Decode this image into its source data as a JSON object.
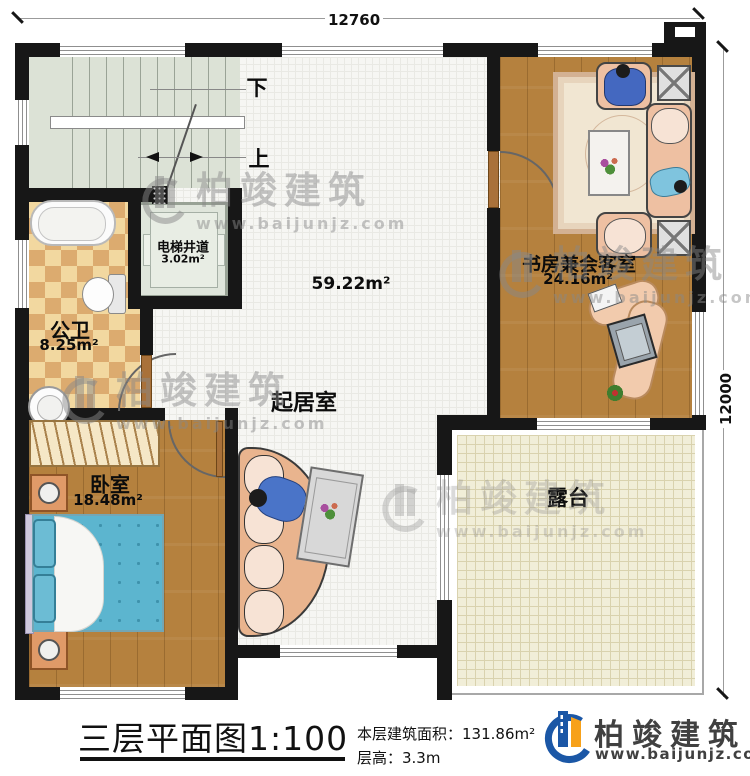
{
  "dimensions": {
    "top": "12760",
    "right": "12000"
  },
  "stairs": {
    "down": "下",
    "up": "上"
  },
  "rooms": {
    "elevator": {
      "name": "电梯井道",
      "area": "3.02m²"
    },
    "bathroom": {
      "name": "公卫",
      "area": "8.25m²"
    },
    "living": {
      "name": "起居室",
      "area": "59.22m²"
    },
    "study": {
      "name": "书房兼会客室",
      "area": "24.16m²"
    },
    "bedroom": {
      "name": "卧室",
      "area": "18.48m²"
    },
    "terrace": {
      "name": "露台"
    }
  },
  "title_block": {
    "title": "三层平面图1:100",
    "building_area": "本层建筑面积：131.86m²",
    "floor_height": "层高：3.3m",
    "brand": "柏竣建筑",
    "website": "www.baijunjz.com"
  },
  "watermark": {
    "brand": "柏竣建筑",
    "website": "www.baijunjz.com"
  },
  "colors": {
    "wall": "#171717",
    "brand_blue": "#1b57a6",
    "brand_orange": "#f7a11a",
    "bed_teal": "#5cb5cf",
    "wood": "#b5813e",
    "terrace_cream": "#f1eed8",
    "stairwell_sage": "#dce2d6",
    "checker_tan": "#dcab6f"
  }
}
